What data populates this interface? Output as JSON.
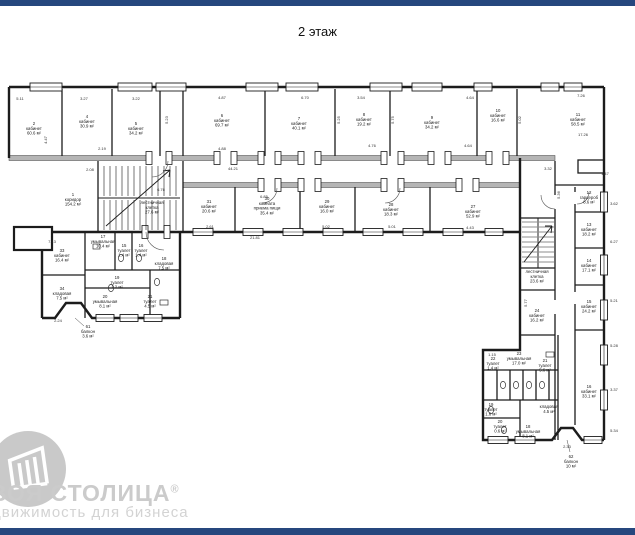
{
  "title": "2 этаж",
  "colors": {
    "bar_navy": "#26477e",
    "wall_black": "#1c1c1c",
    "wall_gray_fill": "#b5b5b5",
    "watermark_gray": "#cbcbcb"
  },
  "watermark": {
    "logo_icon": "building-in-circle",
    "brand": "ВОЯ СТОЛИЦА",
    "reg_mark": "®",
    "tagline": "движимость для бизнеса"
  },
  "floorplan": {
    "rooms": [
      {
        "num": "2",
        "name": "кабинет",
        "area": "60.6 м²",
        "x": 34,
        "y": 125
      },
      {
        "num": "4",
        "name": "кабинет",
        "area": "30.9 м²",
        "x": 87,
        "y": 118
      },
      {
        "num": "5",
        "name": "кабинет",
        "area": "34.2 м²",
        "x": 136,
        "y": 125
      },
      {
        "num": "6",
        "name": "кабинет",
        "area": "69.7 м²",
        "x": 222,
        "y": 117
      },
      {
        "num": "7",
        "name": "кабинет",
        "area": "40.1 м²",
        "x": 299,
        "y": 120
      },
      {
        "num": "8",
        "name": "кабинет",
        "area": "19.2 м²",
        "x": 364,
        "y": 116
      },
      {
        "num": "9",
        "name": "кабинет",
        "area": "34.2 м²",
        "x": 432,
        "y": 119
      },
      {
        "num": "10",
        "name": "кабинет",
        "area": "16.6 м²",
        "x": 498,
        "y": 112
      },
      {
        "num": "11",
        "name": "кабинет",
        "area": "58.5 м²",
        "x": 578,
        "y": 116
      },
      {
        "num": "1",
        "name": "коридор",
        "area": "154.2 м²",
        "x": 73,
        "y": 196
      },
      {
        "num": "",
        "name": "лестничная клетка",
        "area": "27.6 м²",
        "x": 152,
        "y": 204
      },
      {
        "num": "31",
        "name": "кабинет",
        "area": "20.6 м²",
        "x": 209,
        "y": 203
      },
      {
        "num": "30",
        "name": "комната приема пищи",
        "area": "35.4 м²",
        "x": 267,
        "y": 200
      },
      {
        "num": "29",
        "name": "кабинет",
        "area": "16.0 м²",
        "x": 327,
        "y": 203
      },
      {
        "num": "28",
        "name": "кабинет",
        "area": "18.3 м²",
        "x": 391,
        "y": 206
      },
      {
        "num": "27",
        "name": "кабинет",
        "area": "52.9 м²",
        "x": 473,
        "y": 208
      },
      {
        "num": "33",
        "name": "кабинет",
        "area": "16.4 м²",
        "x": 62,
        "y": 252
      },
      {
        "num": "34",
        "name": "кладовая",
        "area": "7.5 м²",
        "x": 62,
        "y": 290
      },
      {
        "num": "17",
        "name": "умывальная",
        "area": "10.4 м²",
        "x": 103,
        "y": 238
      },
      {
        "num": "15",
        "name": "туалет",
        "area": "1.4 м²",
        "x": 124,
        "y": 247
      },
      {
        "num": "16",
        "name": "туалет",
        "area": "1.4 м²",
        "x": 141,
        "y": 247
      },
      {
        "num": "18",
        "name": "кладовая",
        "area": "7.5 м²",
        "x": 164,
        "y": 260
      },
      {
        "num": "19",
        "name": "туалет",
        "area": "1.2 м²",
        "x": 117,
        "y": 279
      },
      {
        "num": "20",
        "name": "умывальная",
        "area": "8.1 м²",
        "x": 105,
        "y": 298
      },
      {
        "num": "21",
        "name": "туалет",
        "area": "4.5 м²",
        "x": 150,
        "y": 298
      },
      {
        "num": "61",
        "name": "балкон",
        "area": "3.6 м²",
        "x": 88,
        "y": 328
      },
      {
        "num": "12",
        "name": "гардероб",
        "area": "8.6 м²",
        "x": 589,
        "y": 194
      },
      {
        "num": "13",
        "name": "кабинет",
        "area": "18.2 м²",
        "x": 589,
        "y": 226
      },
      {
        "num": "14",
        "name": "кабинет",
        "area": "17.1 м²",
        "x": 589,
        "y": 262
      },
      {
        "num": "15",
        "name": "кабинет",
        "area": "24.2 м²",
        "x": 589,
        "y": 303
      },
      {
        "num": "",
        "name": "лестничная клетка",
        "area": "23.6 м²",
        "x": 537,
        "y": 273
      },
      {
        "num": "24",
        "name": "кабинет",
        "area": "16.2 м²",
        "x": 537,
        "y": 312
      },
      {
        "num": "23",
        "name": "умывальная",
        "area": "17.0 м²",
        "x": 519,
        "y": 355
      },
      {
        "num": "16",
        "name": "кабинет",
        "area": "33.1 м²",
        "x": 589,
        "y": 388
      },
      {
        "num": "22",
        "name": "туалет",
        "area": "1.4 м²",
        "x": 493,
        "y": 360
      },
      {
        "num": "21",
        "name": "туалет",
        "area": "5.6 м²",
        "x": 545,
        "y": 362
      },
      {
        "num": "",
        "name": "кладовая",
        "area": "4.5 м²",
        "x": 549,
        "y": 408
      },
      {
        "num": "19",
        "name": "туалет",
        "area": "1.6 м²",
        "x": 491,
        "y": 406
      },
      {
        "num": "20",
        "name": "туалет",
        "area": "0.6 м²",
        "x": 500,
        "y": 423
      },
      {
        "num": "18",
        "name": "умывальная",
        "area": "8.1 м²",
        "x": 528,
        "y": 428
      },
      {
        "num": "62",
        "name": "балкон",
        "area": "10 м²",
        "x": 571,
        "y": 458
      }
    ],
    "dimensions": [
      {
        "x": 20,
        "y": 100,
        "text": "5.11"
      },
      {
        "x": 84,
        "y": 100,
        "text": "3.27"
      },
      {
        "x": 136,
        "y": 100,
        "text": "3.22"
      },
      {
        "x": 222,
        "y": 99,
        "text": "4.87"
      },
      {
        "x": 305,
        "y": 99,
        "text": "6.70"
      },
      {
        "x": 361,
        "y": 99,
        "text": "3.54"
      },
      {
        "x": 470,
        "y": 99,
        "text": "4.64"
      },
      {
        "x": 581,
        "y": 97,
        "text": "7.26"
      },
      {
        "x": 583,
        "y": 136,
        "text": "17.26"
      },
      {
        "x": 372,
        "y": 147,
        "text": "4.76"
      },
      {
        "x": 468,
        "y": 147,
        "text": "4.64"
      },
      {
        "x": 222,
        "y": 150,
        "text": "4.88"
      },
      {
        "x": 102,
        "y": 150,
        "text": "2.19"
      },
      {
        "x": 90,
        "y": 171,
        "text": "2.08"
      },
      {
        "x": 233,
        "y": 170,
        "text": "44.21"
      },
      {
        "x": 264,
        "y": 198,
        "text": "6.85"
      },
      {
        "x": 161,
        "y": 191,
        "text": "6.76"
      },
      {
        "x": 52,
        "y": 243,
        "text": "7.13"
      },
      {
        "x": 58,
        "y": 322,
        "text": "2.24"
      },
      {
        "x": 567,
        "y": 448,
        "text": "2.33"
      },
      {
        "x": 548,
        "y": 170,
        "text": "3.32"
      },
      {
        "x": 560,
        "y": 195,
        "text": "5.36",
        "rot": -90
      },
      {
        "x": 614,
        "y": 205,
        "text": "3.62"
      },
      {
        "x": 614,
        "y": 243,
        "text": "6.27"
      },
      {
        "x": 614,
        "y": 302,
        "text": "5.21"
      },
      {
        "x": 614,
        "y": 347,
        "text": "5.28"
      },
      {
        "x": 614,
        "y": 391,
        "text": "3.37"
      },
      {
        "x": 614,
        "y": 432,
        "text": "5.34"
      },
      {
        "x": 527,
        "y": 303,
        "text": "5.77",
        "rot": -90
      },
      {
        "x": 492,
        "y": 356,
        "text": "1.15"
      },
      {
        "x": 326,
        "y": 228,
        "text": "5.02"
      },
      {
        "x": 392,
        "y": 228,
        "text": "5.01"
      },
      {
        "x": 210,
        "y": 228,
        "text": "2.61"
      },
      {
        "x": 470,
        "y": 229,
        "text": "4.43"
      },
      {
        "x": 255,
        "y": 239,
        "text": "21.81"
      },
      {
        "x": 47,
        "y": 140,
        "text": "4.47",
        "rot": -90
      },
      {
        "x": 168,
        "y": 120,
        "text": "5.23",
        "rot": -90
      },
      {
        "x": 340,
        "y": 120,
        "text": "5.25",
        "rot": -90
      },
      {
        "x": 394,
        "y": 120,
        "text": "5.75",
        "rot": -90
      },
      {
        "x": 521,
        "y": 120,
        "text": "5.02",
        "rot": -90
      },
      {
        "x": 605,
        "y": 175,
        "text": "1.47"
      }
    ]
  }
}
